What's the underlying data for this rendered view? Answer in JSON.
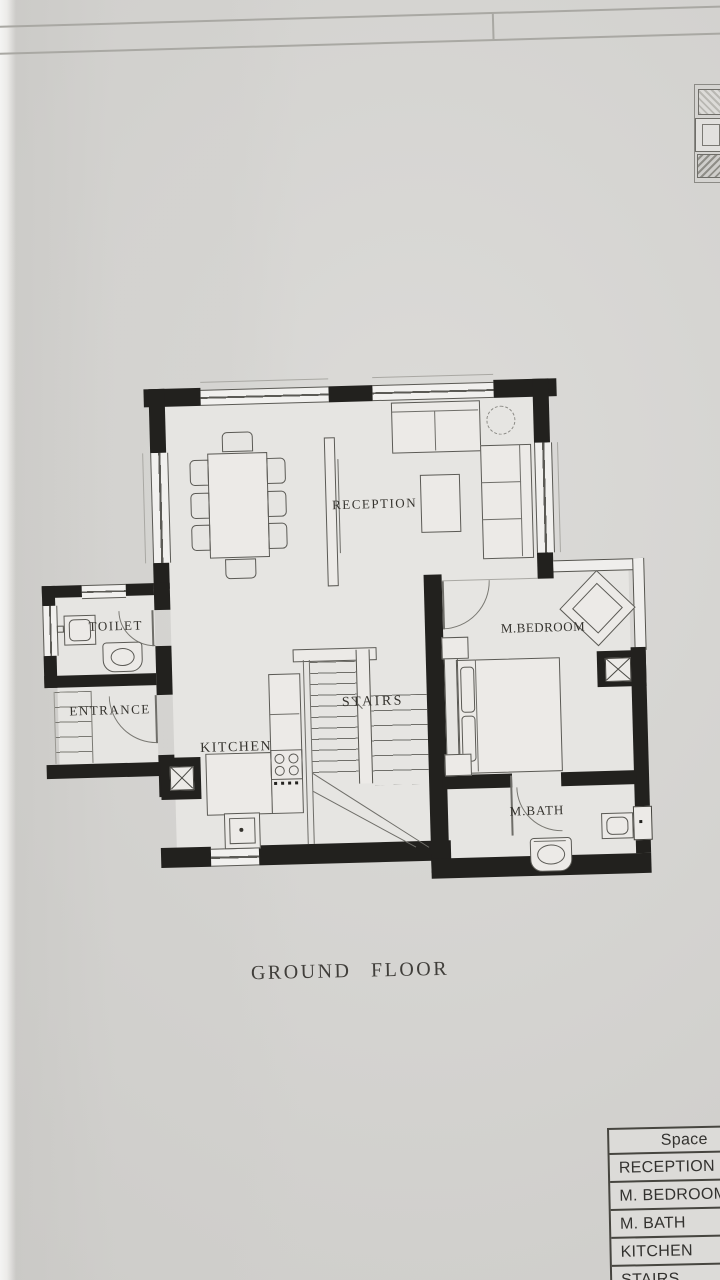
{
  "title": {
    "text": "GROUND FLOOR"
  },
  "plan": {
    "rooms": [
      {
        "id": "reception",
        "label": "RECEPTION"
      },
      {
        "id": "toilet",
        "label": "TOILET"
      },
      {
        "id": "entrance",
        "label": "ENTRANCE"
      },
      {
        "id": "kitchen",
        "label": "KITCHEN"
      },
      {
        "id": "stairs",
        "label": "STAIRS"
      },
      {
        "id": "m_bedroom",
        "label": "M.BEDROOM"
      },
      {
        "id": "m_bath",
        "label": "M.BATH"
      }
    ]
  },
  "spaces_table": {
    "header": "Space",
    "rows": [
      "RECEPTION",
      "M. BEDROOM",
      "M. BATH",
      "KITCHEN",
      "STAIRS"
    ]
  },
  "colors": {
    "paper": "#d8d7d4",
    "wall": "#22211e",
    "ink": "#55544e",
    "label_text": "#35332e"
  }
}
